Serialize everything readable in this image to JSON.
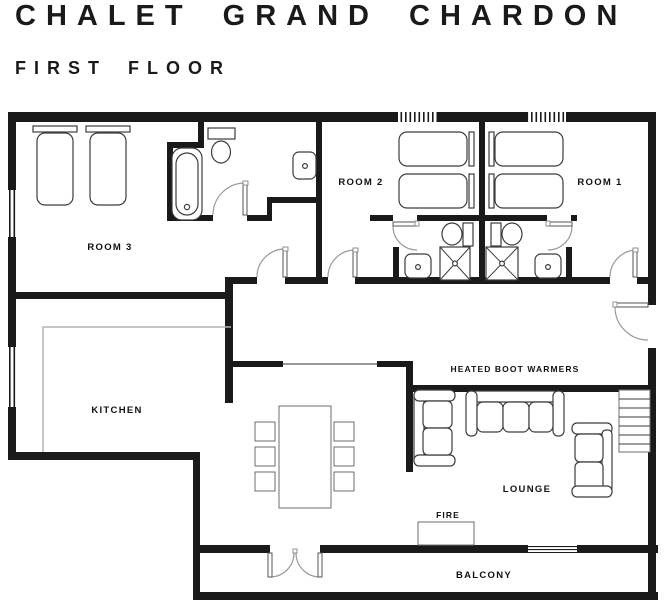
{
  "header": {
    "title": "CHALET GRAND CHARDON",
    "subtitle": "FIRST FLOOR"
  },
  "plan": {
    "labels": {
      "room3": "ROOM 3",
      "room2": "ROOM 2",
      "room1": "ROOM 1",
      "kitchen": "KITCHEN",
      "boot_warmers": "HEATED BOOT WARMERS",
      "lounge": "LOUNGE",
      "fire": "FIRE",
      "balcony": "BALCONY"
    },
    "colors": {
      "wall": "#1a1a1a",
      "text": "#111111",
      "furniture_outline": "#3c3c3c",
      "door_arc": "#999999",
      "counter_gray": "#b3b3b3"
    }
  }
}
